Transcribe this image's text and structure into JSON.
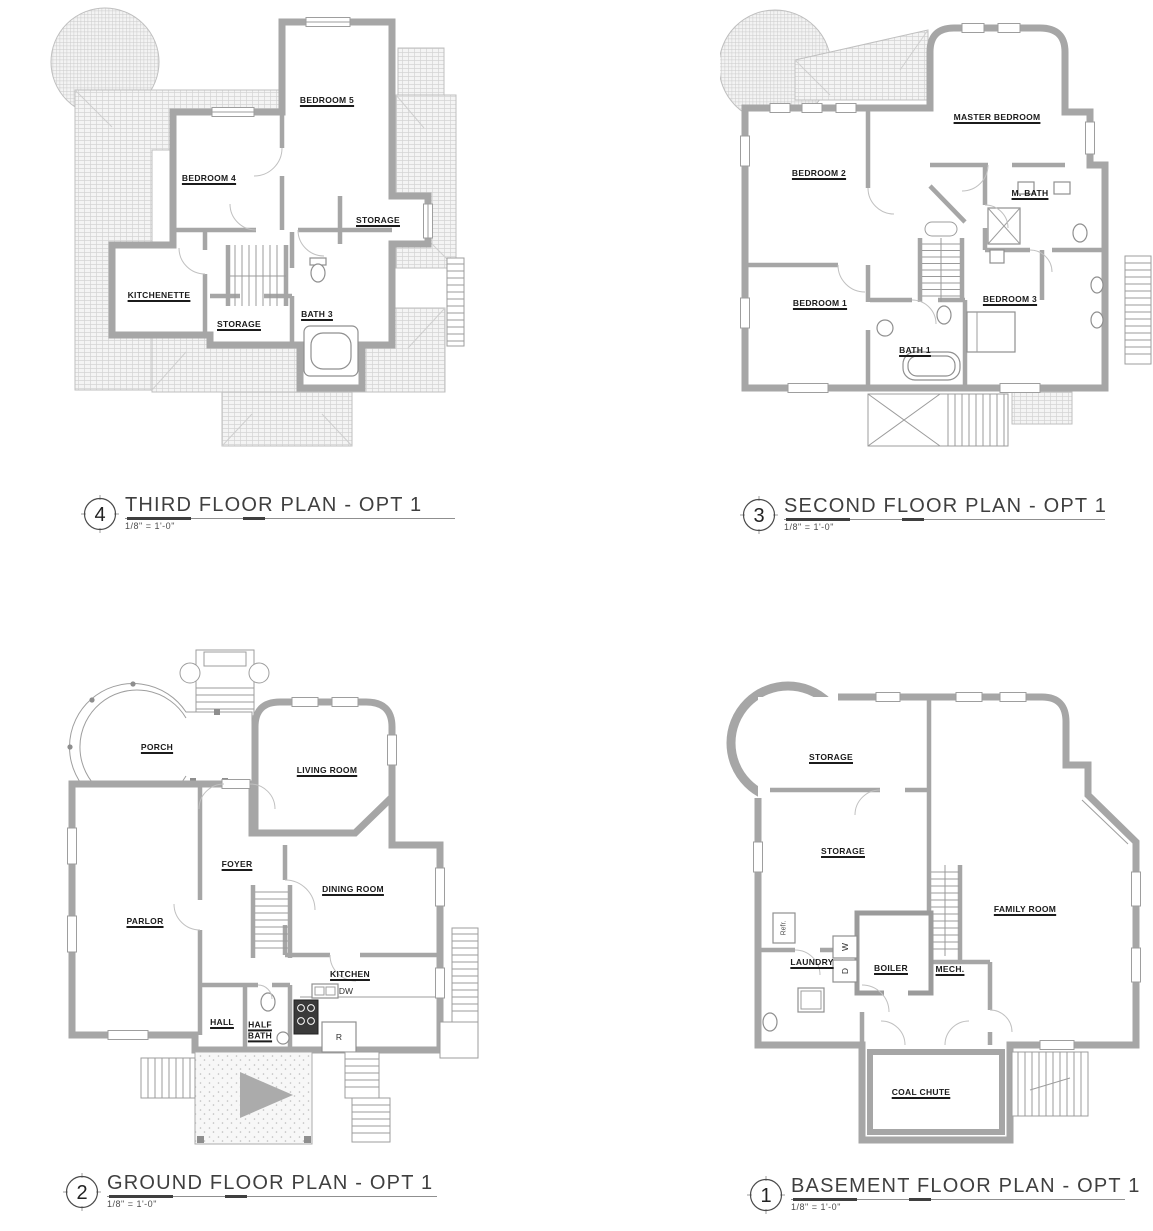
{
  "colors": {
    "wall": "#a6a6a6",
    "roof_hatch": "#d9d9d9",
    "label_text": "#1b1b1b",
    "title_text": "#3f3f3f"
  },
  "plans": [
    {
      "id": "third-floor",
      "number": "4",
      "title": "THIRD FLOOR PLAN - OPT 1",
      "scale": "1/8\" = 1'-0\"",
      "rooms": [
        "BEDROOM 5",
        "BEDROOM 4",
        "STORAGE",
        "KITCHENETTE",
        "STORAGE",
        "BATH 3"
      ]
    },
    {
      "id": "second-floor",
      "number": "3",
      "title": "SECOND FLOOR PLAN - OPT 1",
      "scale": "1/8\" = 1'-0\"",
      "rooms": [
        "MASTER BEDROOM",
        "BEDROOM 2",
        "M. BATH",
        "BEDROOM 1",
        "BATH 1",
        "BEDROOM 3"
      ]
    },
    {
      "id": "ground-floor",
      "number": "2",
      "title": "GROUND FLOOR PLAN - OPT 1",
      "scale": "1/8\" = 1'-0\"",
      "rooms": [
        "PORCH",
        "LIVING ROOM",
        "FOYER",
        "DINING ROOM",
        "PARLOR",
        "KITCHEN",
        "HALL",
        "HALF BATH"
      ],
      "appliances": [
        "DW",
        "R"
      ]
    },
    {
      "id": "basement",
      "number": "1",
      "title": "BASEMENT FLOOR PLAN - OPT 1",
      "scale": "1/8\" = 1'-0\"",
      "rooms": [
        "STORAGE",
        "STORAGE",
        "FAMILY ROOM",
        "LAUNDRY",
        "BOILER",
        "MECH.",
        "COAL CHUTE"
      ],
      "appliances": [
        "W",
        "D",
        "Refr."
      ]
    }
  ]
}
